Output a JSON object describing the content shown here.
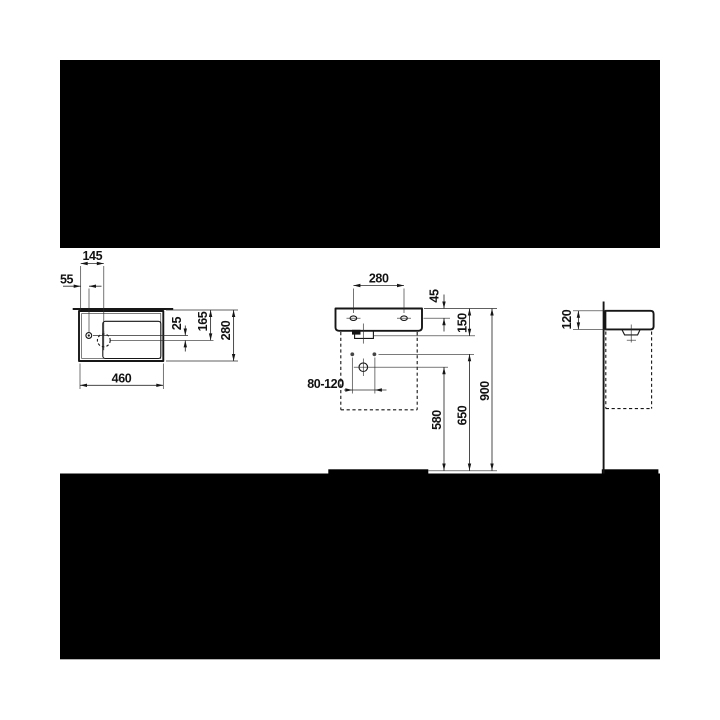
{
  "colors": {
    "line": "#161616",
    "thin_line": "#2b2b2b",
    "letterbox": "#000000",
    "background": "#ffffff"
  },
  "dims": {
    "top_view": {
      "d145": "145",
      "d55": "55",
      "d25": "25",
      "d165": "165",
      "d280": "280",
      "d460": "460"
    },
    "front_view": {
      "d280": "280",
      "d45": "45",
      "d150": "150",
      "d80_120": "80-120",
      "d580": "580",
      "d650": "650",
      "d900": "900"
    },
    "side_view": {
      "d120": "120"
    }
  }
}
